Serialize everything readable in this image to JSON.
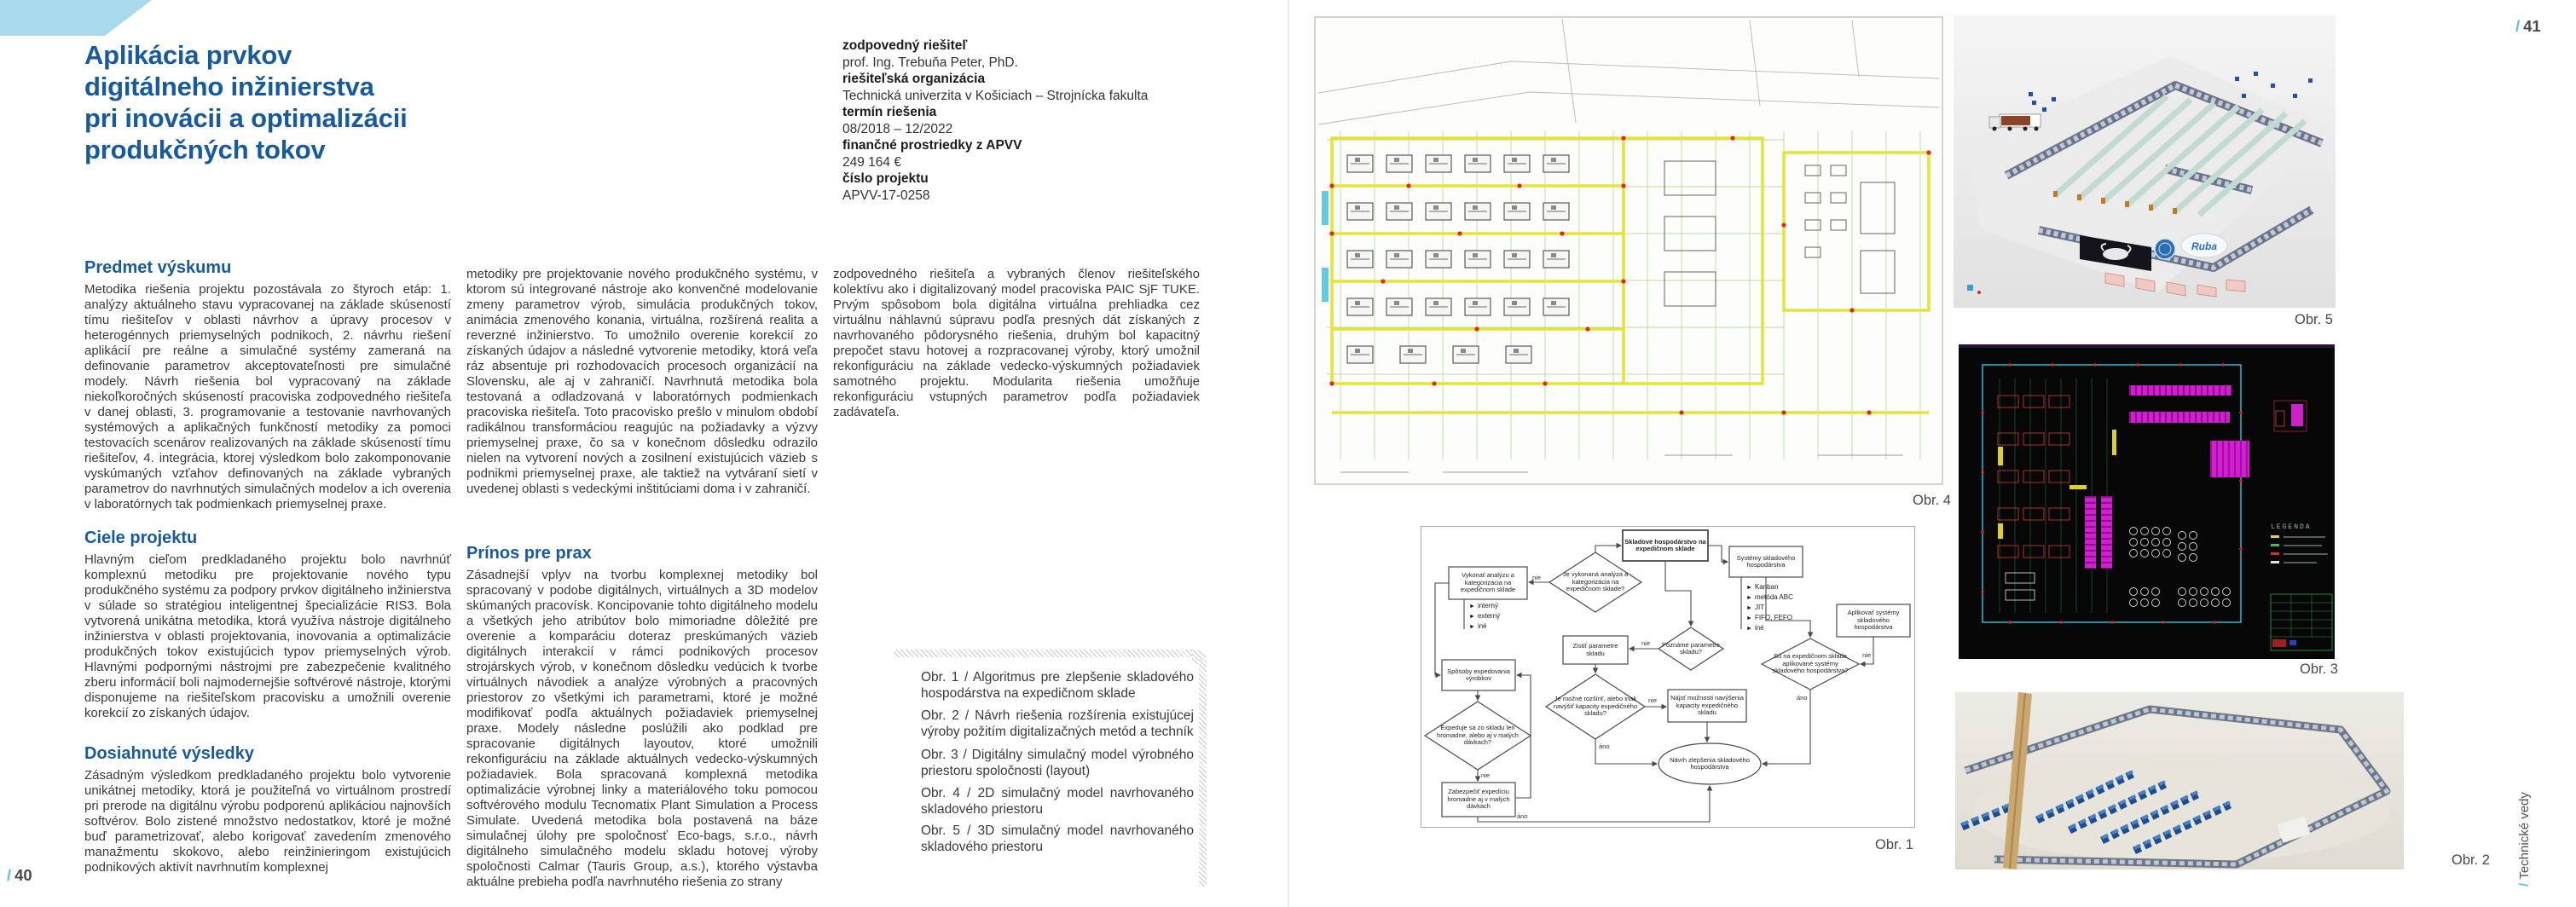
{
  "colors": {
    "accent_blue": "#185a9f",
    "cyan_accent": "#55c3dd",
    "corner_blue": "#a9d9ed",
    "body_text": "#3a3a3a",
    "caption_text": "#4a4a4a"
  },
  "article": {
    "title": "Aplikácia prvkov\ndigitálneho inžinierstva\npri inovácii a optimalizácii\nprodukčných tokov",
    "meta": [
      {
        "label": "zodpovedný riešiteľ",
        "value": "prof. Ing. Trebuňa Peter, PhD."
      },
      {
        "label": "riešiteľská organizácia",
        "value": "Technická univerzita v Košiciach – Strojnícka fakulta"
      },
      {
        "label": "termín riešenia",
        "value": "08/2018 – 12/2022"
      },
      {
        "label": "finančné prostriedky z APVV",
        "value": "249 164 €"
      },
      {
        "label": "číslo projektu",
        "value": "APVV-17-0258"
      }
    ],
    "sections": {
      "predmet": {
        "heading": "Predmet výskumu",
        "text": "Metodika riešenia projektu pozostávala zo štyroch etáp: 1. analýzy aktuálneho stavu vypracovanej na základe skúseností tímu riešiteľov v oblasti návrhov a úpravy procesov v heterogénnych priemyselných podnikoch, 2. návrhu riešení aplikácií pre reálne a simulačné systémy zameraná na definovanie parametrov akceptovateľnosti pre simulačné modely. Návrh riešenia bol vypracovaný na základe niekoľkoročných skúseností pracoviska zodpovedného riešiteľa v danej oblasti, 3. programovanie a testovanie navrhovaných systémových a aplikačných funkčností metodiky za pomoci testovacích scenárov realizovaných na základe skúseností tímu riešiteľov, 4. integrácia, ktorej výsledkom bolo zakomponovanie vyskúmaných vzťahov definovaných na základe vybraných parametrov do navrhnutých simulačných modelov a ich overenia v laboratórnych tak podmienkach priemyselnej praxe."
      },
      "ciele": {
        "heading": "Ciele projektu",
        "text": "Hlavným cieľom predkladaného projektu bolo navrhnúť komplexnú metodiku pre projektovanie nového typu produkčného systému za podpory prvkov digitálneho inžinierstva v súlade so stratégiou inteligentnej špecializácie RIS3. Bola vytvorená unikátna metodika, ktorá využíva nástroje digitálneho inžinierstva v oblasti projektovania, inovovania a optimalizácie produkčných tokov existujúcich typov priemyselných výrob. Hlavnými podpornými nástrojmi pre zabezpečenie kvalitného zberu informácií boli najmodernejšie softvérové nástroje, ktorými disponujeme na riešiteľskom pracovisku a umožnili overenie korekcií zo získaných údajov."
      },
      "dosiahnute": {
        "heading": "Dosiahnuté výsledky",
        "text_col1": "Zásadným výsledkom predkladaného projektu bolo vytvorenie unikátnej metodiky, ktorá je použiteľná vo virtuálnom prostredí pri prerode na digitálnu výrobu podporenú aplikáciou najnovších softvérov. Bolo zistené množstvo nedostatkov, ktoré je možné buď parametrizovať, alebo korigovať zavedením zmenového manažmentu skokovo, alebo reinžinieringom existujúcich podnikových aktivít navrhnutím komplexnej",
        "text_col2": "metodiky pre projektovanie nového produkčného systému, v ktorom sú integrované nástroje ako konvenčné modelovanie zmeny parametrov výrob, simulácia produkčných tokov, animácia zmenového konania, virtuálna, rozšírená realita a reverzné inžinierstvo. To umožnilo overenie korekcií zo získaných údajov a následné vytvorenie metodiky, ktorá veľa ráz absentuje pri rozhodovacích procesoch organizácií na Slovensku, ale aj v zahraničí. Navrhnutá metodika bola testovaná a odladzovaná v laboratórnych podmienkach pracoviska riešiteľa. Toto pracovisko prešlo v minulom období radikálnou transformáciou reagujúc na požiadavky a výzvy priemyselnej praxe, čo sa v konečnom dôsledku odrazilo nielen na vytvorení nových a zosilnení existujúcich väzieb s podnikmi priemyselnej praxe, ale taktiež na vytváraní sietí v uvedenej oblasti s vedeckými inštitúciami doma i v zahraničí."
      },
      "prinos": {
        "heading": "Prínos pre prax",
        "text_col2": "Zásadnejší vplyv na tvorbu komplexnej metodiky bol spracovaný v podobe digitálnych, virtuálnych a 3D modelov skúmaných pracovísk. Koncipovanie tohto digitálneho modelu a všetkých jeho atribútov bolo mimoriadne dôležité pre overenie a komparáciu doteraz preskúmaných väzieb digitálnych interakcií v rámci podnikových procesov strojárskych výrob, v konečnom dôsledku vedúcich k tvorbe virtuálnych návodiek a analýze výrobných a pracovných priestorov zo všetkými ich parametrami, ktoré je možné modifikovať podľa aktuálnych požiadaviek priemyselnej praxe. Modely následne poslúžili ako podklad pre spracovanie digitálnych layoutov, ktoré umožnili rekonfiguráciu na základe aktuálnych vedecko-výskumných požiadaviek. Bola spracovaná komplexná metodika optimalizácie výrobnej linky a materiálového toku pomocou softvérového modulu Tecnomatix Plant Simulation a Process Simulate. Uvedená metodika bola postavená na báze simulačnej úlohy pre spoločnosť Eco-bags, s.r.o., návrh digitálneho simulačného modelu skladu hotovej výroby spoločnosti Calmar (Tauris Group, a.s.), ktorého výstavba aktuálne prebieha podľa navrhnutého riešenia zo strany",
        "text_col3": "zodpovedného riešiteľa a vybraných členov riešiteľského kolektívu ako i digitalizovaný model pracoviska PAIC SjF TUKE. Prvým spôsobom bola digitálna virtuálna prehliadka cez virtuálnu náhlavnú súpravu podľa presných dát získaných z navrhovaného pôdorysného riešenia, druhým bol kapacitný prepočet stavu hotovej a rozpracovanej výroby, ktorý umožnil rekonfiguráciu na základe vedecko-výskumných požiadaviek samotného projektu. Modularita riešenia umožňuje rekonfiguráciu vstupných parametrov podľa požiadaviek zadávateľa."
      }
    },
    "figure_captions": [
      "Obr. 1 / Algoritmus pre zlepšenie skladového hospodárstva na expedičnom sklade",
      "Obr. 2 / Návrh riešenia rozšírenia existujúcej výroby požitím digitalizačných metód a techník",
      "Obr. 3 / Digitálny simulačný model výrobného priestoru spoločnosti (layout)",
      "Obr. 4 / 2D simulačný model navrhovaného skladového priestoru",
      "Obr. 5 / 3D simulačný model navrhovaného skladového priestoru"
    ]
  },
  "pagination": {
    "left": {
      "slash": "/",
      "number": "40"
    },
    "right": {
      "slash": "/",
      "number": "41"
    }
  },
  "section_tag": {
    "slash": "/",
    "label": "Technické vedy"
  },
  "figures": {
    "fig1": {
      "label": "Obr. 1"
    },
    "fig2": {
      "label": "Obr. 2"
    },
    "fig3": {
      "label": "Obr. 3",
      "legend_title": "LEGENDA"
    },
    "fig4": {
      "label": "Obr. 4"
    },
    "fig5": {
      "label": "Obr. 5",
      "logo_text": "Ruba"
    }
  },
  "flowchart": {
    "yes": "áno",
    "no": "nie",
    "nodes": {
      "start": "Skladové hospodárstvo na expedičnom sklade",
      "d_analysis": "Je vykonaná analýza a kategorizácia na expedičnom sklade?",
      "analyze": "Vykonať analýzu a kategorizácia na expedičnom sklade",
      "d_params": "Poznáme parametre skladu?",
      "get_params": "Zistiť parametre skladu",
      "d_expand": "Je možné rozšíriť, alebo inak navýšiť kapacity expedičného skladu?",
      "find_options": "Nájsť možnosti navýšenia kapacity expedičného skladu",
      "dispatch_methods": "Spôsoby expedovania výrobkov",
      "d_batches": "Expeduje sa zo skladu len hromadne, alebo aj v malých dávkach?",
      "ensure_dispatch": "Zabezpečiť expedíciu hromadne aj v malých dávkach",
      "systems": "Systémy skladového hospodárstva",
      "apply_systems": "Aplikovať systémy skladového hospodárstva",
      "d_systems": "Sú na expedičnom sklade aplikované systémy skladového hospodárstva?",
      "end": "Návrh zlepšenia skladového hospodárstva"
    },
    "analysis_types": [
      "interný",
      "externý",
      "iné"
    ],
    "system_types": [
      "Kanban",
      "metóda ABC",
      "JIT",
      "FIFO, FEFO",
      "iné"
    ]
  }
}
